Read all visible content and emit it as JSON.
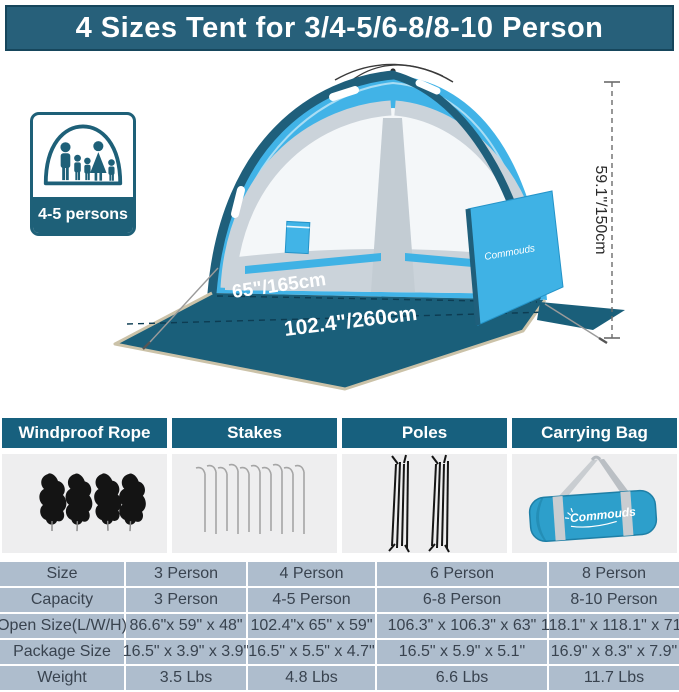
{
  "title": "4 Sizes Tent for 3/4-5/6-8/8-10 Person",
  "badge": {
    "label": "4-5 persons"
  },
  "tent": {
    "height_label": "59.1\"/150cm",
    "width_label": "65\"/165cm",
    "depth_label": "102.4\"/260cm",
    "brand": "Commouds"
  },
  "accessories": [
    {
      "label": "Windproof Rope"
    },
    {
      "label": "Stakes"
    },
    {
      "label": "Poles"
    },
    {
      "label": "Carrying Bag",
      "brand": "Commouds"
    }
  ],
  "spec_table": {
    "rows": [
      [
        "Size",
        "3 Person",
        "4 Person",
        "6 Person",
        "8 Person"
      ],
      [
        "Capacity",
        "3 Person",
        "4-5 Person",
        "6-8 Person",
        "8-10 Person"
      ],
      [
        "Open Size(L/W/H)",
        "86.6\"x 59\" x 48\"",
        "102.4\"x 65\" x 59\"",
        "106.3\" x 106.3\" x 63\"",
        "118.1\" x 118.1\" x 71\""
      ],
      [
        "Package Size",
        "16.5\" x 3.9\" x 3.9\"",
        "16.5\" x 5.5\" x 4.7\"",
        "16.5\" x 5.9\" x 5.1\"",
        "16.9\" x 8.3\" x 7.9\""
      ],
      [
        "Weight",
        "3.5 Lbs",
        "4.8 Lbs",
        "6.6 Lbs",
        "11.7 Lbs"
      ]
    ]
  },
  "colors": {
    "teal_dark": "#17607E",
    "title_teal": "#27607A",
    "sky_blue": "#41B3E7",
    "floor_teal": "#1A5F7A",
    "table_cell": "#AEBDCD"
  }
}
